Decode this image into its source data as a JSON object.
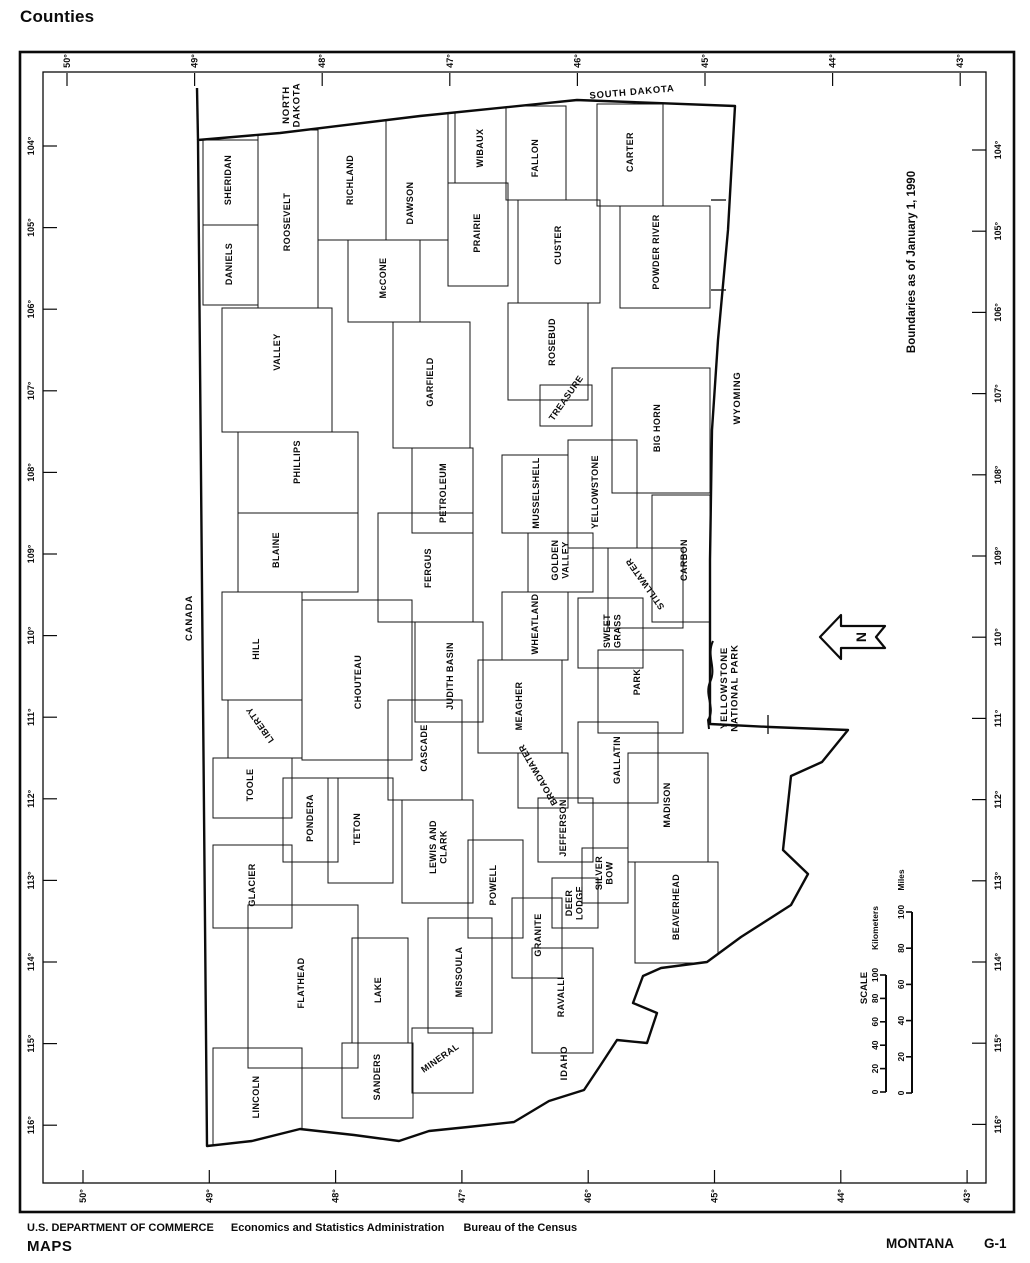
{
  "title": "Counties",
  "footer": {
    "agency": "U.S. DEPARTMENT OF COMMERCE",
    "division": "Economics and Statistics Administration",
    "bureau": "Bureau of the Census",
    "brand": "MAPS",
    "state": "MONTANA",
    "page_code": "G-1"
  },
  "map": {
    "note": "Boundaries as of January 1, 1990",
    "north_arrow_label": "N",
    "scale": {
      "title": "SCALE",
      "bars": [
        {
          "unit": "Kilometers",
          "ticks": [
            "0",
            "20",
            "40",
            "60",
            "80",
            "100"
          ]
        },
        {
          "unit": "Miles",
          "ticks": [
            "0",
            "20",
            "40",
            "60",
            "80",
            "100"
          ]
        }
      ]
    },
    "axes": {
      "top": [
        "50°",
        "49°",
        "48°",
        "47°",
        "46°",
        "45°",
        "44°",
        "43°"
      ],
      "bottom": [
        "50°",
        "49°",
        "48°",
        "47°",
        "46°",
        "45°",
        "44°",
        "43°"
      ],
      "left": [
        "104°",
        "105°",
        "106°",
        "107°",
        "108°",
        "109°",
        "110°",
        "111°",
        "112°",
        "113°",
        "114°",
        "115°",
        "116°"
      ],
      "right": [
        "104°",
        "105°",
        "106°",
        "107°",
        "108°",
        "109°",
        "110°",
        "111°",
        "112°",
        "113°",
        "114°",
        "115°",
        "116°"
      ]
    },
    "neighbors": [
      {
        "name": "CANADA",
        "x": 189,
        "y": 618,
        "rot": -90
      },
      {
        "name": "NORTH DAKOTA",
        "lines": [
          "NORTH",
          "DAKOTA"
        ],
        "x": 291,
        "y": 105,
        "rot": -90
      },
      {
        "name": "SOUTH DAKOTA",
        "x": 632,
        "y": 92,
        "rot": -5
      },
      {
        "name": "WYOMING",
        "x": 737,
        "y": 398,
        "rot": -90
      },
      {
        "name": "IDAHO",
        "x": 564,
        "y": 1063,
        "rot": -90
      },
      {
        "name": "YELLOWSTONE NATIONAL PARK",
        "lines": [
          "YELLOWSTONE",
          "NATIONAL PARK"
        ],
        "x": 729,
        "y": 688,
        "rot": -90
      }
    ],
    "counties": [
      {
        "name": "SHERIDAN",
        "x": 228,
        "y": 180,
        "rot": -90,
        "box": [
          203,
          140,
          258,
          225
        ]
      },
      {
        "name": "DANIELS",
        "x": 229,
        "y": 264,
        "rot": -90,
        "box": [
          203,
          225,
          258,
          305
        ]
      },
      {
        "name": "ROOSEVELT",
        "x": 287,
        "y": 222,
        "rot": -90,
        "box": [
          258,
          130,
          318,
          308
        ]
      },
      {
        "name": "RICHLAND",
        "x": 350,
        "y": 180,
        "rot": -90,
        "box": [
          318,
          116,
          386,
          240
        ]
      },
      {
        "name": "DAWSON",
        "x": 410,
        "y": 203,
        "rot": -90,
        "box": [
          386,
          112,
          448,
          240
        ]
      },
      {
        "name": "WIBAUX",
        "x": 480,
        "y": 148,
        "rot": -90,
        "box": [
          455,
          108,
          506,
          183
        ]
      },
      {
        "name": "FALLON",
        "x": 535,
        "y": 158,
        "rot": -90,
        "box": [
          506,
          106,
          566,
          200
        ]
      },
      {
        "name": "CARTER",
        "x": 630,
        "y": 152,
        "rot": -90,
        "box": [
          597,
          104,
          663,
          206
        ]
      },
      {
        "name": "McCONE",
        "x": 383,
        "y": 278,
        "rot": -90,
        "box": [
          348,
          240,
          420,
          322
        ]
      },
      {
        "name": "PRAIRIE",
        "x": 477,
        "y": 233,
        "rot": -90,
        "box": [
          448,
          183,
          508,
          286
        ]
      },
      {
        "name": "CUSTER",
        "x": 558,
        "y": 245,
        "rot": -90,
        "box": [
          518,
          200,
          600,
          303
        ]
      },
      {
        "name": "POWDER RIVER",
        "x": 656,
        "y": 252,
        "rot": -90,
        "box": [
          620,
          206,
          710,
          308
        ]
      },
      {
        "name": "VALLEY",
        "x": 277,
        "y": 352,
        "rot": -90,
        "box": [
          222,
          308,
          332,
          432
        ]
      },
      {
        "name": "GARFIELD",
        "x": 430,
        "y": 382,
        "rot": -90,
        "box": [
          393,
          322,
          470,
          448
        ]
      },
      {
        "name": "ROSEBUD",
        "x": 552,
        "y": 342,
        "rot": -90,
        "box": [
          508,
          303,
          588,
          400
        ]
      },
      {
        "name": "TREASURE",
        "x": 566,
        "y": 398,
        "rot": -55,
        "box": [
          540,
          385,
          592,
          426
        ]
      },
      {
        "name": "BIG HORN",
        "x": 657,
        "y": 428,
        "rot": -90,
        "box": [
          612,
          368,
          710,
          493
        ]
      },
      {
        "name": "PHILLIPS",
        "x": 297,
        "y": 462,
        "rot": -90,
        "box": [
          238,
          432,
          358,
          513
        ]
      },
      {
        "name": "BLAINE",
        "x": 276,
        "y": 550,
        "rot": -90,
        "box": [
          238,
          513,
          358,
          592
        ]
      },
      {
        "name": "HILL",
        "x": 256,
        "y": 649,
        "rot": -90,
        "box": [
          222,
          592,
          302,
          700
        ]
      },
      {
        "name": "LIBERTY",
        "x": 260,
        "y": 725,
        "rot": -125,
        "box": [
          228,
          700,
          302,
          758
        ]
      },
      {
        "name": "PETROLEUM",
        "x": 443,
        "y": 493,
        "rot": -90,
        "box": [
          412,
          448,
          473,
          533
        ]
      },
      {
        "name": "FERGUS",
        "x": 428,
        "y": 568,
        "rot": -90,
        "box": [
          378,
          513,
          473,
          622
        ]
      },
      {
        "name": "MUSSELSHELL",
        "x": 536,
        "y": 493,
        "rot": -90,
        "box": [
          502,
          455,
          568,
          533
        ]
      },
      {
        "name": "GOLDEN VALLEY",
        "lines": [
          "GOLDEN",
          "VALLEY"
        ],
        "x": 560,
        "y": 560,
        "rot": -90,
        "box": [
          528,
          533,
          593,
          592
        ]
      },
      {
        "name": "WHEATLAND",
        "x": 535,
        "y": 624,
        "rot": -90,
        "box": [
          502,
          592,
          568,
          660
        ]
      },
      {
        "name": "JUDITH BASIN",
        "x": 450,
        "y": 676,
        "rot": -90,
        "box": [
          415,
          622,
          483,
          722
        ]
      },
      {
        "name": "CHOUTEAU",
        "x": 358,
        "y": 682,
        "rot": -90,
        "box": [
          302,
          600,
          412,
          760
        ]
      },
      {
        "name": "MEAGHER",
        "x": 519,
        "y": 706,
        "rot": -90,
        "box": [
          478,
          660,
          562,
          753
        ]
      },
      {
        "name": "CASCADE",
        "x": 424,
        "y": 748,
        "rot": -90,
        "box": [
          388,
          700,
          462,
          800
        ]
      },
      {
        "name": "YELLOWSTONE",
        "x": 595,
        "y": 492,
        "rot": -90,
        "box": [
          568,
          440,
          637,
          548
        ]
      },
      {
        "name": "CARBON",
        "x": 684,
        "y": 560,
        "rot": -90,
        "box": [
          652,
          495,
          710,
          622
        ]
      },
      {
        "name": "STILLWATER",
        "x": 645,
        "y": 584,
        "rot": -125,
        "box": [
          608,
          548,
          683,
          628
        ]
      },
      {
        "name": "SWEET GRASS",
        "lines": [
          "SWEET",
          "GRASS"
        ],
        "x": 612,
        "y": 631,
        "rot": -90,
        "box": [
          578,
          598,
          643,
          668
        ]
      },
      {
        "name": "PARK",
        "x": 637,
        "y": 682,
        "rot": -90,
        "box": [
          598,
          650,
          683,
          733
        ]
      },
      {
        "name": "GALLATIN",
        "x": 617,
        "y": 760,
        "rot": -90,
        "box": [
          578,
          722,
          658,
          803
        ]
      },
      {
        "name": "TOOLE",
        "x": 250,
        "y": 785,
        "rot": -90,
        "box": [
          213,
          758,
          292,
          818
        ]
      },
      {
        "name": "PONDERA",
        "x": 310,
        "y": 818,
        "rot": -90,
        "box": [
          283,
          778,
          338,
          862
        ]
      },
      {
        "name": "TETON",
        "x": 357,
        "y": 829,
        "rot": -90,
        "box": [
          328,
          778,
          393,
          883
        ]
      },
      {
        "name": "GLACIER",
        "x": 252,
        "y": 885,
        "rot": -90,
        "box": [
          213,
          845,
          292,
          928
        ]
      },
      {
        "name": "LEWIS AND CLARK",
        "lines": [
          "LEWIS AND",
          "CLARK"
        ],
        "x": 438,
        "y": 847,
        "rot": -90,
        "box": [
          402,
          800,
          473,
          903
        ]
      },
      {
        "name": "POWELL",
        "x": 493,
        "y": 885,
        "rot": -90,
        "box": [
          468,
          840,
          523,
          938
        ]
      },
      {
        "name": "BROADWATER",
        "x": 538,
        "y": 775,
        "rot": -120,
        "box": [
          518,
          753,
          568,
          808
        ]
      },
      {
        "name": "JEFFERSON",
        "x": 563,
        "y": 828,
        "rot": -90,
        "box": [
          538,
          798,
          593,
          862
        ]
      },
      {
        "name": "MADISON",
        "x": 667,
        "y": 805,
        "rot": -90,
        "box": [
          628,
          753,
          708,
          862
        ]
      },
      {
        "name": "SILVER BOW",
        "lines": [
          "SILVER",
          "BOW"
        ],
        "x": 604,
        "y": 873,
        "rot": -90,
        "box": [
          582,
          848,
          628,
          903
        ]
      },
      {
        "name": "DEER LODGE",
        "lines": [
          "DEER",
          "LODGE"
        ],
        "x": 574,
        "y": 903,
        "rot": -90,
        "box": [
          552,
          878,
          598,
          928
        ]
      },
      {
        "name": "GRANITE",
        "x": 538,
        "y": 935,
        "rot": -90,
        "box": [
          512,
          898,
          562,
          978
        ]
      },
      {
        "name": "BEAVERHEAD",
        "x": 676,
        "y": 907,
        "rot": -90,
        "box": [
          635,
          862,
          718,
          963
        ]
      },
      {
        "name": "FLATHEAD",
        "x": 301,
        "y": 983,
        "rot": -90,
        "box": [
          248,
          905,
          358,
          1068
        ]
      },
      {
        "name": "LAKE",
        "x": 378,
        "y": 990,
        "rot": -90,
        "box": [
          352,
          938,
          408,
          1043
        ]
      },
      {
        "name": "MISSOULA",
        "x": 459,
        "y": 972,
        "rot": -90,
        "box": [
          428,
          918,
          492,
          1033
        ]
      },
      {
        "name": "RAVALLI",
        "x": 561,
        "y": 997,
        "rot": -90,
        "box": [
          532,
          948,
          593,
          1053
        ]
      },
      {
        "name": "MINERAL",
        "x": 440,
        "y": 1058,
        "rot": -35,
        "box": [
          412,
          1028,
          473,
          1093
        ]
      },
      {
        "name": "SANDERS",
        "x": 377,
        "y": 1077,
        "rot": -90,
        "box": [
          342,
          1043,
          413,
          1118
        ]
      },
      {
        "name": "LINCOLN",
        "x": 256,
        "y": 1097,
        "rot": -90,
        "box": [
          213,
          1048,
          302,
          1146
        ]
      }
    ]
  }
}
